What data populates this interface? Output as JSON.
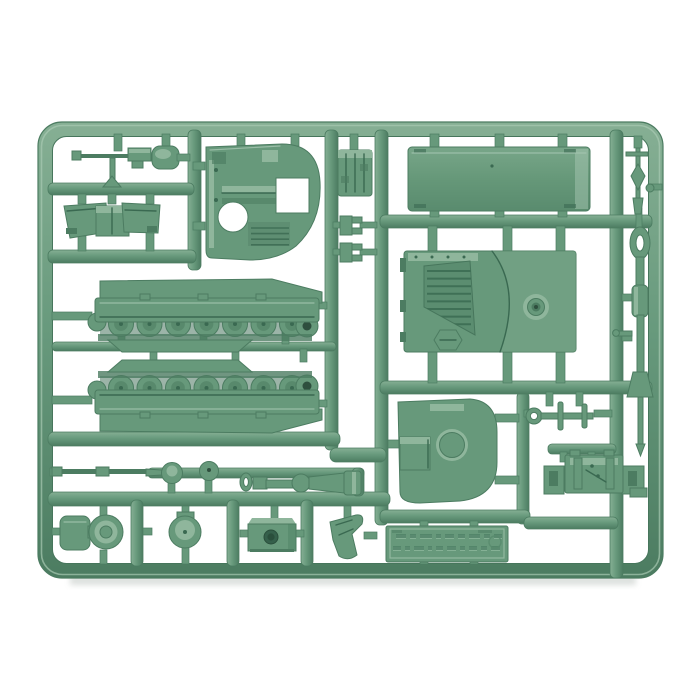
{
  "meta": {
    "description": "Product photo of a single green plastic injection-moulded model kit sprue containing small-scale tank parts (turret top, hull floor plate, engine deck, two mirrored track/hull units, gun barrels, hatches, cupola, gun cradle and accessories) laid on a plain white background.",
    "alt": "Green plastic sprue of tank model parts on white background"
  },
  "palette": {
    "background": "#ffffff",
    "plastic_base": "#67997b",
    "plastic_light": "#8fb69c",
    "plastic_lighter": "#a6c6b1",
    "plastic_dark": "#4c7c61",
    "plastic_darker": "#3a6951",
    "hole_dark": "#2e4f3e",
    "photo_shadow": "#9aa59e"
  },
  "sprue": {
    "material": "green styrene plastic",
    "parts": [
      {
        "id": "aa-machine-gun",
        "label": "anti-aircraft machine gun"
      },
      {
        "id": "stowage-knob",
        "label": "small rounded stowage part"
      },
      {
        "id": "fender-pair",
        "label": "pair of angled fenders with centre box"
      },
      {
        "id": "turret-top",
        "label": "turret top shell with hatch openings"
      },
      {
        "id": "engine-access-box",
        "label": "ribbed engine access box"
      },
      {
        "id": "clip-small-1",
        "label": "small bracket clip"
      },
      {
        "id": "clip-small-2",
        "label": "small bracket clip"
      },
      {
        "id": "hull-floor-plate",
        "label": "large flat hull floor plate"
      },
      {
        "id": "antenna-mast",
        "label": "antenna / MG mast"
      },
      {
        "id": "gun-barrel",
        "label": "main gun barrel with lifting loop and muzzle"
      },
      {
        "id": "engine-deck",
        "label": "hull top engine deck with grills and turret ring dome"
      },
      {
        "id": "track-unit-upper",
        "label": "tracked hull side, wheels facing down"
      },
      {
        "id": "track-unit-lower",
        "label": "tracked hull side, wheels facing up"
      },
      {
        "id": "turret-base",
        "label": "rounded turret base plate with boss"
      },
      {
        "id": "towing-linkage",
        "label": "towing linkage with ring"
      },
      {
        "id": "gun-cradle",
        "label": "gun cradle mount with side brackets"
      },
      {
        "id": "thin-gun-barrel",
        "label": "thin secondary gun barrel"
      },
      {
        "id": "hatch-disc-1",
        "label": "round hatch disc"
      },
      {
        "id": "hatch-disc-2",
        "label": "round hatch disc"
      },
      {
        "id": "gun-mount-cone",
        "label": "conical gun mount"
      },
      {
        "id": "cupola-with-hatch",
        "label": "cupola with open hatch flap"
      },
      {
        "id": "round-hatch",
        "label": "round hatch with hinge tab"
      },
      {
        "id": "mantlet-block",
        "label": "mantlet block with bore hole"
      },
      {
        "id": "angled-bracket",
        "label": "angled bracket"
      },
      {
        "id": "maker-plate",
        "label": "embossed manufacturer plate"
      }
    ],
    "track_unit": {
      "wheel_count": 7,
      "wheel_x0": 121,
      "wheel_cy": 324,
      "wheel_spacing": 28.5,
      "wheel_r": 12.5,
      "mirror_offset": 712
    },
    "deck_grill": {
      "rib_count": 8,
      "x1": 427,
      "x2": 471,
      "y0": 271,
      "dy": 7.6
    },
    "turret_grill": {
      "rib_count": 4,
      "x1": 251,
      "x2": 289,
      "y0": 228,
      "dy": 5.6
    },
    "embossed_plate": {
      "legible": false,
      "lines": 2,
      "dash_pattern_1": [
        10,
        6,
        12,
        5,
        9,
        7,
        11,
        6,
        8
      ],
      "dash_pattern_2": [
        8,
        5,
        10,
        4,
        7,
        9,
        5,
        8,
        6,
        9
      ],
      "dash_gap": 4,
      "line1_x": 396,
      "line1_y": 534,
      "line2_x": 393,
      "line2_y": 546,
      "dash_h": 4
    }
  }
}
